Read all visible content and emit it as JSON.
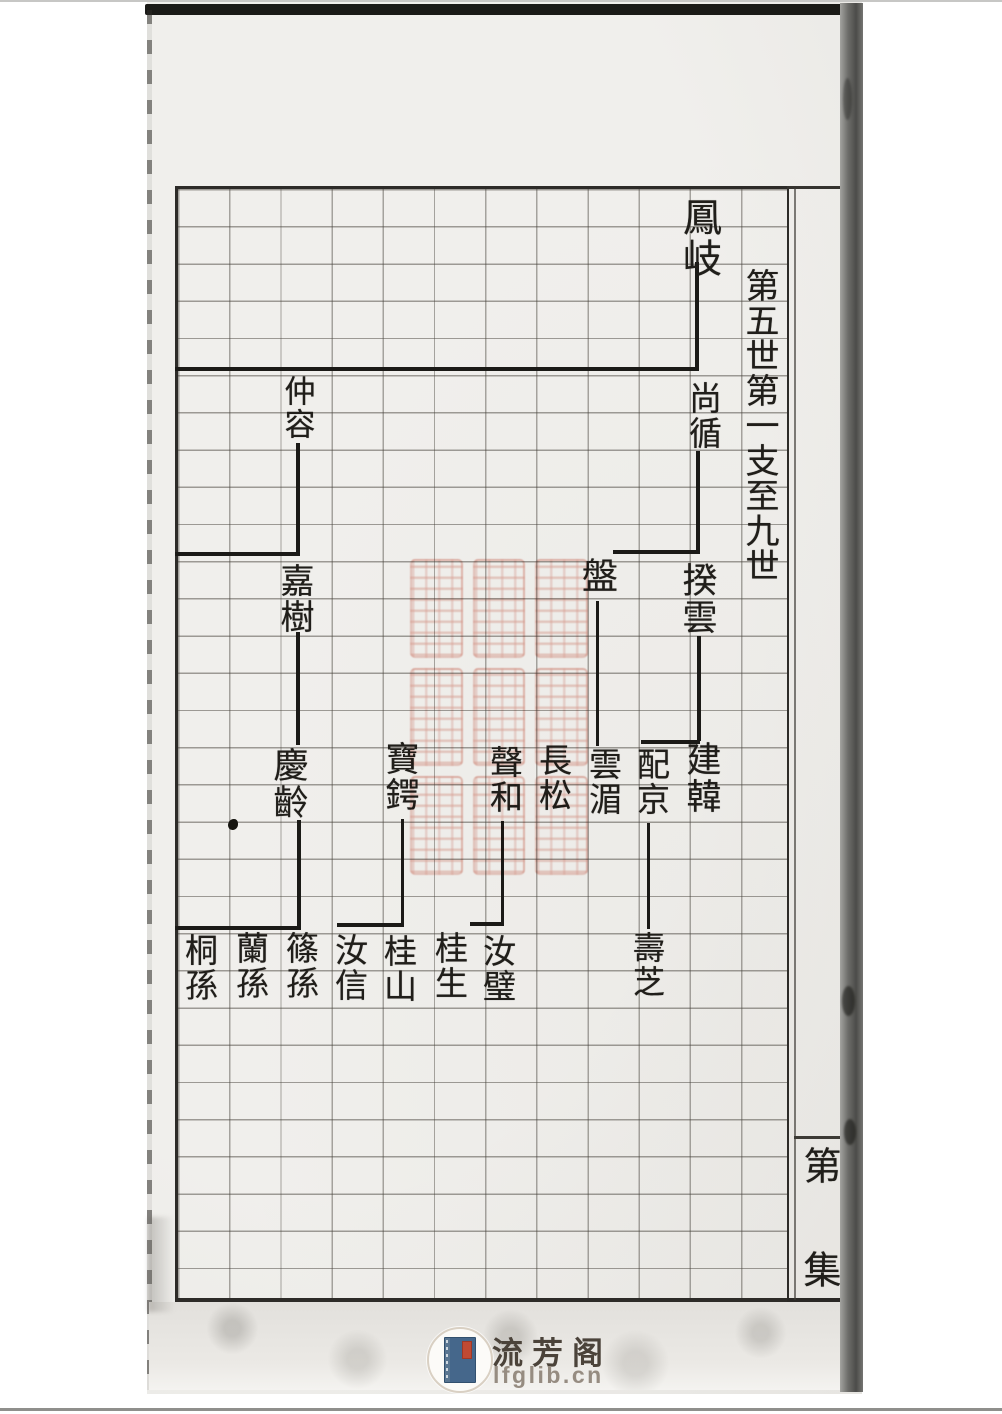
{
  "document": {
    "type": "genealogy-chart-scan",
    "generation_header": "第五世第一支至九世",
    "margin_label": {
      "top": "第",
      "bottom": "集"
    },
    "tree": {
      "nodes": [
        "鳳岐",
        "尚循",
        "仲容",
        "嘉樹",
        "盤",
        "揆雲",
        "慶齡",
        "寶鍔",
        "聲和",
        "長松",
        "雲湄",
        "配京",
        "建韓",
        "桐孫",
        "蘭孫",
        "篠孫",
        "汝信",
        "桂山",
        "桂生",
        "汝璧",
        "壽芝"
      ],
      "relations": [
        {
          "parent": "鳳岐",
          "children": [
            "仲容",
            "尚循"
          ]
        },
        {
          "parent": "仲容",
          "children": [
            "嘉樹"
          ]
        },
        {
          "parent": "尚循",
          "children": [
            "盤",
            "揆雲"
          ]
        },
        {
          "parent": "嘉樹",
          "children": [
            "慶齡"
          ]
        },
        {
          "parent": "盤",
          "children": [
            "雲湄"
          ]
        },
        {
          "parent": "揆雲",
          "children": [
            "配京",
            "建韓"
          ]
        },
        {
          "parent": "慶齡",
          "children": [
            "桐孫",
            "蘭孫",
            "篠孫"
          ]
        },
        {
          "parent": "寶鍔",
          "children": [
            "汝信",
            "桂山"
          ]
        },
        {
          "parent": "聲和",
          "children": [
            "桂生",
            "汝璧"
          ]
        },
        {
          "parent": "配京",
          "children": [
            "壽芝"
          ]
        }
      ]
    },
    "seal": {
      "description": "red library collection seal, illegible seal script",
      "color": "#cb523c"
    }
  },
  "watermark": {
    "site_name": "流芳阁",
    "site_url": "lfglib.cn",
    "icon": "stitched-book-icon"
  }
}
